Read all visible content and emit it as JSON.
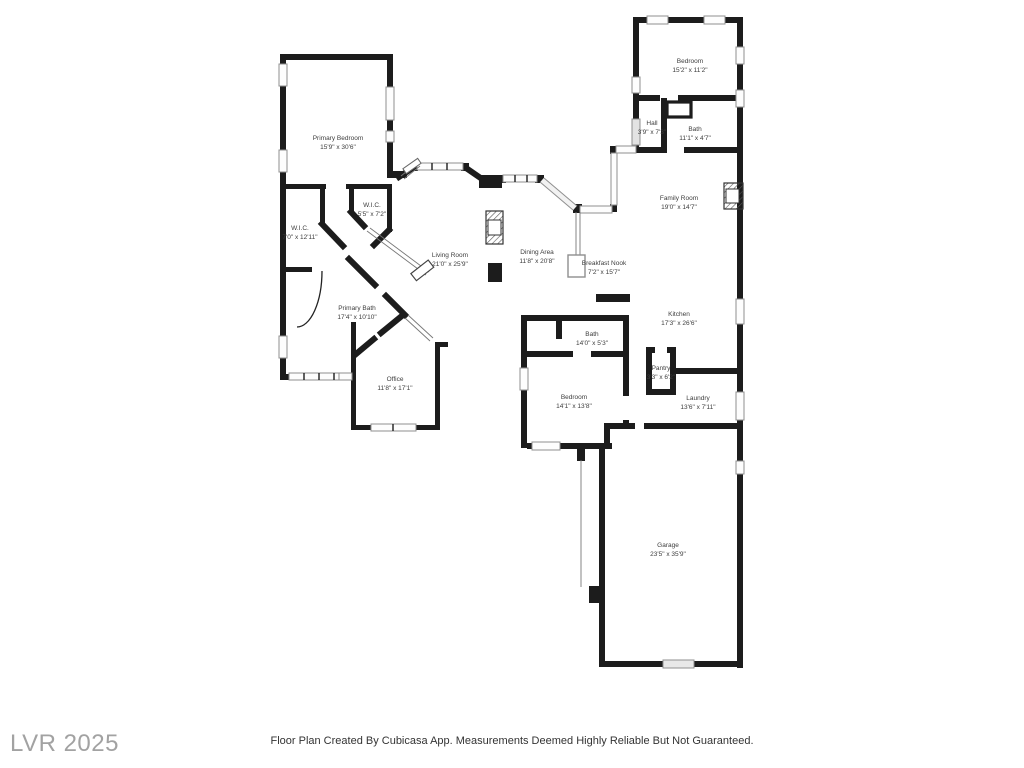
{
  "watermark": {
    "text": "LVR 2025",
    "color": "#a2a2a2"
  },
  "footer": {
    "text": "Floor Plan Created By Cubicasa App. Measurements Deemed Highly Reliable But Not Guaranteed."
  },
  "colors": {
    "background": "#ffffff",
    "wall": "#1c1c1c",
    "window_fill": "#fdfdfd",
    "window_border": "#8f8f8f",
    "label_text": "#3d3d3d",
    "watermark_text": "#a2a2a2",
    "footer_text": "#333333"
  },
  "rooms": [
    {
      "name": "Primary Bedroom",
      "dims": "15'9\" x 30'6\""
    },
    {
      "name": "W.I.C.",
      "dims": "5'5\" x 7'2\""
    },
    {
      "name": "W.I.C.",
      "dims": "7'0\" x 12'11\""
    },
    {
      "name": "Primary Bath",
      "dims": "17'4\" x 10'10\""
    },
    {
      "name": "Office",
      "dims": "11'8\" x 17'1\""
    },
    {
      "name": "Living Room",
      "dims": "21'0\" x 25'9\""
    },
    {
      "name": "Dining Area",
      "dims": "11'8\" x 20'8\""
    },
    {
      "name": "Breakfast Nook",
      "dims": "7'2\" x 15'7\""
    },
    {
      "name": "Family Room",
      "dims": "19'0\" x 14'7\""
    },
    {
      "name": "Bedroom",
      "dims": "15'2\" x 11'2\""
    },
    {
      "name": "Hall",
      "dims": "3'9\" x 7'3\""
    },
    {
      "name": "Bath",
      "dims": "11'1\" x 4'7\""
    },
    {
      "name": "Kitchen",
      "dims": "17'3\" x 26'6\""
    },
    {
      "name": "Pantry",
      "dims": "3'3\" x 6'2\""
    },
    {
      "name": "Laundry",
      "dims": "13'6\" x 7'11\""
    },
    {
      "name": "Bath",
      "dims": "14'0\" x 5'3\""
    },
    {
      "name": "Bedroom",
      "dims": "14'1\" x 13'8\""
    },
    {
      "name": "Garage",
      "dims": "23'5\" x 35'9\""
    }
  ]
}
